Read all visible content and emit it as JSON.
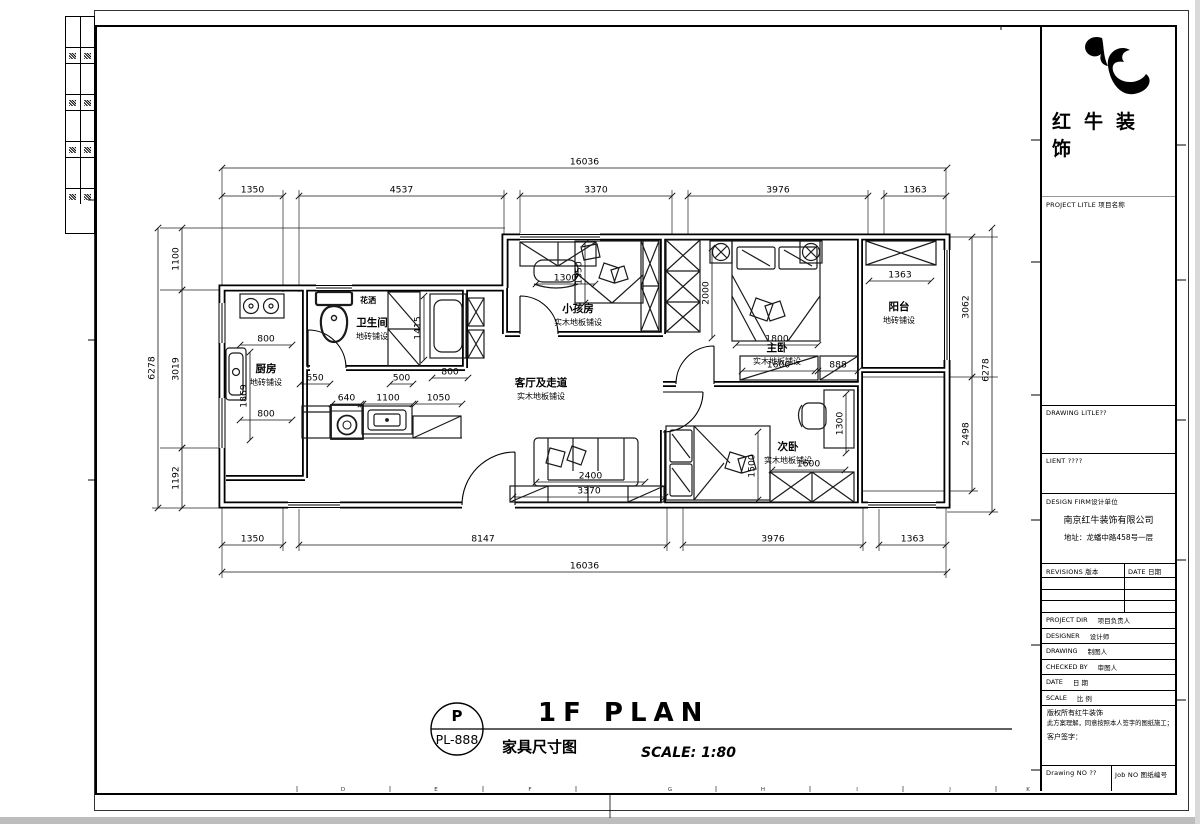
{
  "colors": {
    "ink": "#000000",
    "paper": "#ffffff",
    "gray_edge": "#bdbdbd"
  },
  "title_block": {
    "company": "红牛装饰",
    "project_title": "PROJECT LITLE 项目名称",
    "drawing_title": "DRAWING LITLE??",
    "client": "LIENT ????",
    "design_firm": "DESIGN FIRM设计单位",
    "firm_name": "南京红牛装饰有限公司",
    "firm_address": "地址：龙蟠中路458号一层",
    "revisions_col": "REVISIONS 版本",
    "date_col": "DATE 日期",
    "rows": [
      {
        "en": "PROJECT DIR",
        "cn": "项目负责人"
      },
      {
        "en": "DESIGNER",
        "cn": "设计师"
      },
      {
        "en": "DRAWING",
        "cn": "制图人"
      },
      {
        "en": "CHECKED BY",
        "cn": "审图人"
      },
      {
        "en": "DATE",
        "cn": "日  期"
      },
      {
        "en": "SCALE",
        "cn": "比  例"
      }
    ],
    "copyright_1": "版权所有红牛装饰",
    "copyright_2": "此方案理解，同意按照本人签字的图纸施工；",
    "copyright_3": "客户签字：",
    "drawing_no": "Drawing NO ??",
    "job_no": "Job NO 图纸编号"
  },
  "footer": {
    "stamp_top": "P",
    "stamp_bottom": "PL-888",
    "plan_title": "1F PLAN",
    "plan_subtitle": "家具尺寸图",
    "scale": "SCALE: 1:80"
  },
  "grid_letters": [
    "D",
    "E",
    "F",
    "G",
    "H",
    "I",
    "J",
    "K"
  ],
  "plan": {
    "rooms": [
      {
        "name": "厨房",
        "floor": "地砖铺设",
        "x": 266,
        "y": 372
      },
      {
        "name": "卫生间",
        "floor": "地砖铺设",
        "x": 372,
        "y": 326
      },
      {
        "name": "小孩房",
        "floor": "实木地板铺设",
        "x": 578,
        "y": 312
      },
      {
        "name": "主卧",
        "floor": "实木地板铺设",
        "x": 777,
        "y": 351
      },
      {
        "name": "阳台",
        "floor": "地砖铺设",
        "x": 899,
        "y": 310
      },
      {
        "name": "次卧",
        "floor": "实木地板铺设",
        "x": 788,
        "y": 450
      },
      {
        "name": "客厅及走道",
        "floor": "实木地板铺设",
        "x": 541,
        "y": 386
      }
    ],
    "labels": [
      {
        "t": "花洒",
        "x": 368,
        "y": 303
      }
    ],
    "dims": [
      {
        "v": "16036",
        "x1": 222,
        "y1": 168,
        "x2": 947,
        "y2": 168
      },
      {
        "v": "1350",
        "x1": 222,
        "y1": 196,
        "x2": 283,
        "y2": 196
      },
      {
        "v": "4537",
        "x1": 299,
        "y1": 196,
        "x2": 504,
        "y2": 196
      },
      {
        "v": "3370",
        "x1": 520,
        "y1": 196,
        "x2": 672,
        "y2": 196
      },
      {
        "v": "3976",
        "x1": 688,
        "y1": 196,
        "x2": 868,
        "y2": 196
      },
      {
        "v": "1363",
        "x1": 884,
        "y1": 196,
        "x2": 946,
        "y2": 196
      },
      {
        "v": "1350",
        "x1": 222,
        "y1": 545,
        "x2": 283,
        "y2": 545
      },
      {
        "v": "8147",
        "x1": 299,
        "y1": 545,
        "x2": 667,
        "y2": 545
      },
      {
        "v": "3976",
        "x1": 683,
        "y1": 545,
        "x2": 863,
        "y2": 545
      },
      {
        "v": "1363",
        "x1": 879,
        "y1": 545,
        "x2": 946,
        "y2": 545
      },
      {
        "v": "16036",
        "x1": 222,
        "y1": 572,
        "x2": 947,
        "y2": 572
      },
      {
        "v": "1100",
        "x1": 182,
        "y1": 228,
        "x2": 182,
        "y2": 290
      },
      {
        "v": "3019",
        "x1": 182,
        "y1": 290,
        "x2": 182,
        "y2": 448
      },
      {
        "v": "1192",
        "x1": 182,
        "y1": 448,
        "x2": 182,
        "y2": 508
      },
      {
        "v": "6278",
        "x1": 158,
        "y1": 228,
        "x2": 158,
        "y2": 508
      },
      {
        "v": "3062",
        "x1": 972,
        "y1": 237,
        "x2": 972,
        "y2": 377
      },
      {
        "v": "2498",
        "x1": 972,
        "y1": 377,
        "x2": 972,
        "y2": 491
      },
      {
        "v": "6278",
        "x1": 992,
        "y1": 228,
        "x2": 992,
        "y2": 512
      },
      {
        "v": "800",
        "x1": 240,
        "y1": 345,
        "x2": 292,
        "y2": 345
      },
      {
        "v": "1869",
        "x1": 250,
        "y1": 352,
        "x2": 250,
        "y2": 440
      },
      {
        "v": "800",
        "x1": 240,
        "y1": 420,
        "x2": 292,
        "y2": 420
      },
      {
        "v": "650",
        "x1": 300,
        "y1": 384,
        "x2": 330,
        "y2": 384
      },
      {
        "v": "500",
        "x1": 390,
        "y1": 384,
        "x2": 413,
        "y2": 384
      },
      {
        "v": "1415",
        "x1": 424,
        "y1": 296,
        "x2": 424,
        "y2": 360
      },
      {
        "v": "800",
        "x1": 432,
        "y1": 378,
        "x2": 468,
        "y2": 378
      },
      {
        "v": "640",
        "x1": 332,
        "y1": 404,
        "x2": 361,
        "y2": 404
      },
      {
        "v": "1100",
        "x1": 363,
        "y1": 404,
        "x2": 413,
        "y2": 404
      },
      {
        "v": "1050",
        "x1": 415,
        "y1": 404,
        "x2": 462,
        "y2": 404
      },
      {
        "v": "1300",
        "x1": 536,
        "y1": 284,
        "x2": 595,
        "y2": 284
      },
      {
        "v": "1350",
        "x1": 585,
        "y1": 243,
        "x2": 585,
        "y2": 303
      },
      {
        "v": "2000",
        "x1": 712,
        "y1": 248,
        "x2": 712,
        "y2": 338
      },
      {
        "v": "1800",
        "x1": 736,
        "y1": 345,
        "x2": 818,
        "y2": 345
      },
      {
        "v": "1600",
        "x1": 742,
        "y1": 371,
        "x2": 815,
        "y2": 371
      },
      {
        "v": "888",
        "x1": 818,
        "y1": 371,
        "x2": 858,
        "y2": 371
      },
      {
        "v": "1363",
        "x1": 869,
        "y1": 281,
        "x2": 931,
        "y2": 281
      },
      {
        "v": "1300",
        "x1": 846,
        "y1": 394,
        "x2": 846,
        "y2": 453
      },
      {
        "v": "1500",
        "x1": 758,
        "y1": 432,
        "x2": 758,
        "y2": 500
      },
      {
        "v": "1600",
        "x1": 772,
        "y1": 470,
        "x2": 845,
        "y2": 470
      },
      {
        "v": "2400",
        "x1": 536,
        "y1": 482,
        "x2": 645,
        "y2": 482
      },
      {
        "v": "3370",
        "x1": 513,
        "y1": 497,
        "x2": 665,
        "y2": 497
      }
    ]
  }
}
